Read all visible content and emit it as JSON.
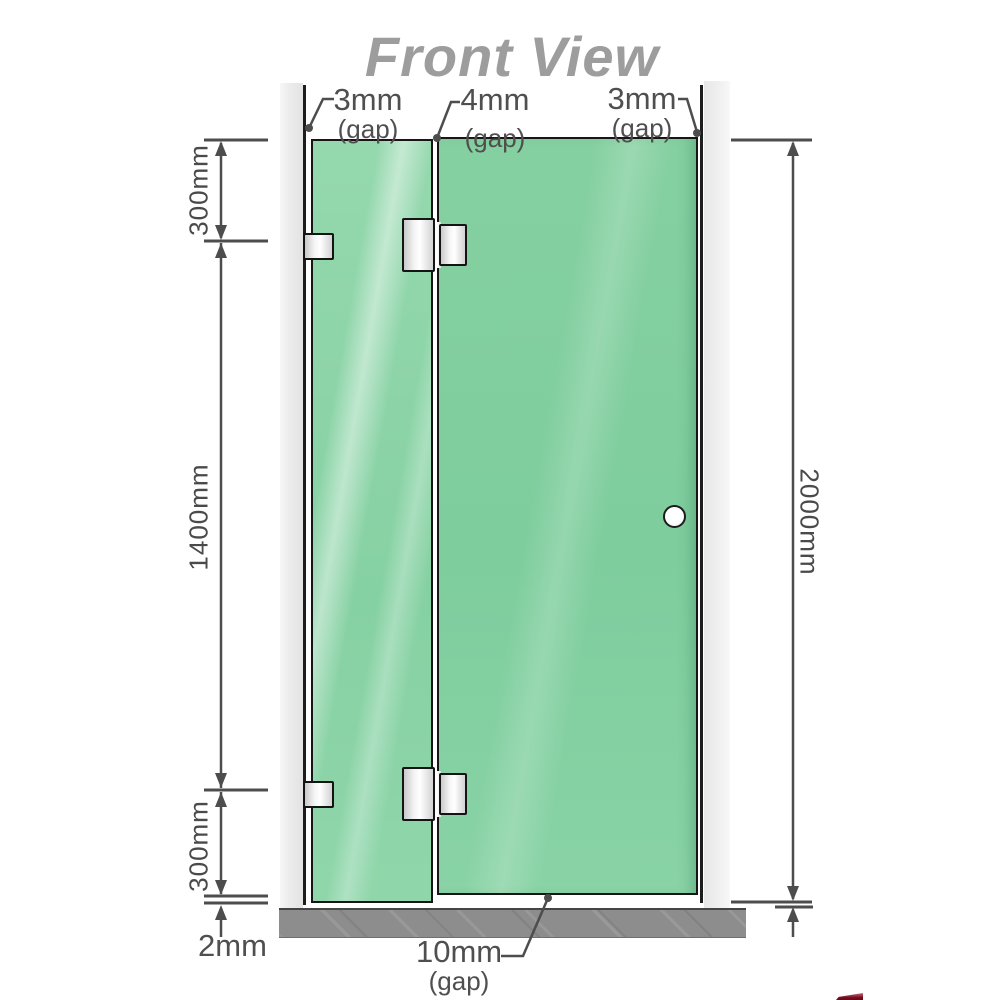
{
  "title": "Front View",
  "dimensions": {
    "left_top": "300mm",
    "left_middle": "1400mm",
    "left_bottom": "300mm",
    "right_height": "2000mm",
    "floor_gap": "2mm"
  },
  "gaps": {
    "left": {
      "value": "3mm",
      "label": "(gap)"
    },
    "middle": {
      "value": "4mm",
      "label": "(gap)"
    },
    "right": {
      "value": "3mm",
      "label": "(gap)"
    },
    "bottom": {
      "value": "10mm",
      "label": "(gap)"
    }
  },
  "colors": {
    "glass_green": "#87d1a3",
    "glass_highlight": "#c9edd9",
    "wall_gray": "#ebebeb",
    "floor_gray": "#8d8d8d",
    "dimension_gray": "#4d4d4d",
    "title_gray": "#9d9d9d",
    "hardware_outline": "#161616",
    "logo_red": "#70081a"
  }
}
